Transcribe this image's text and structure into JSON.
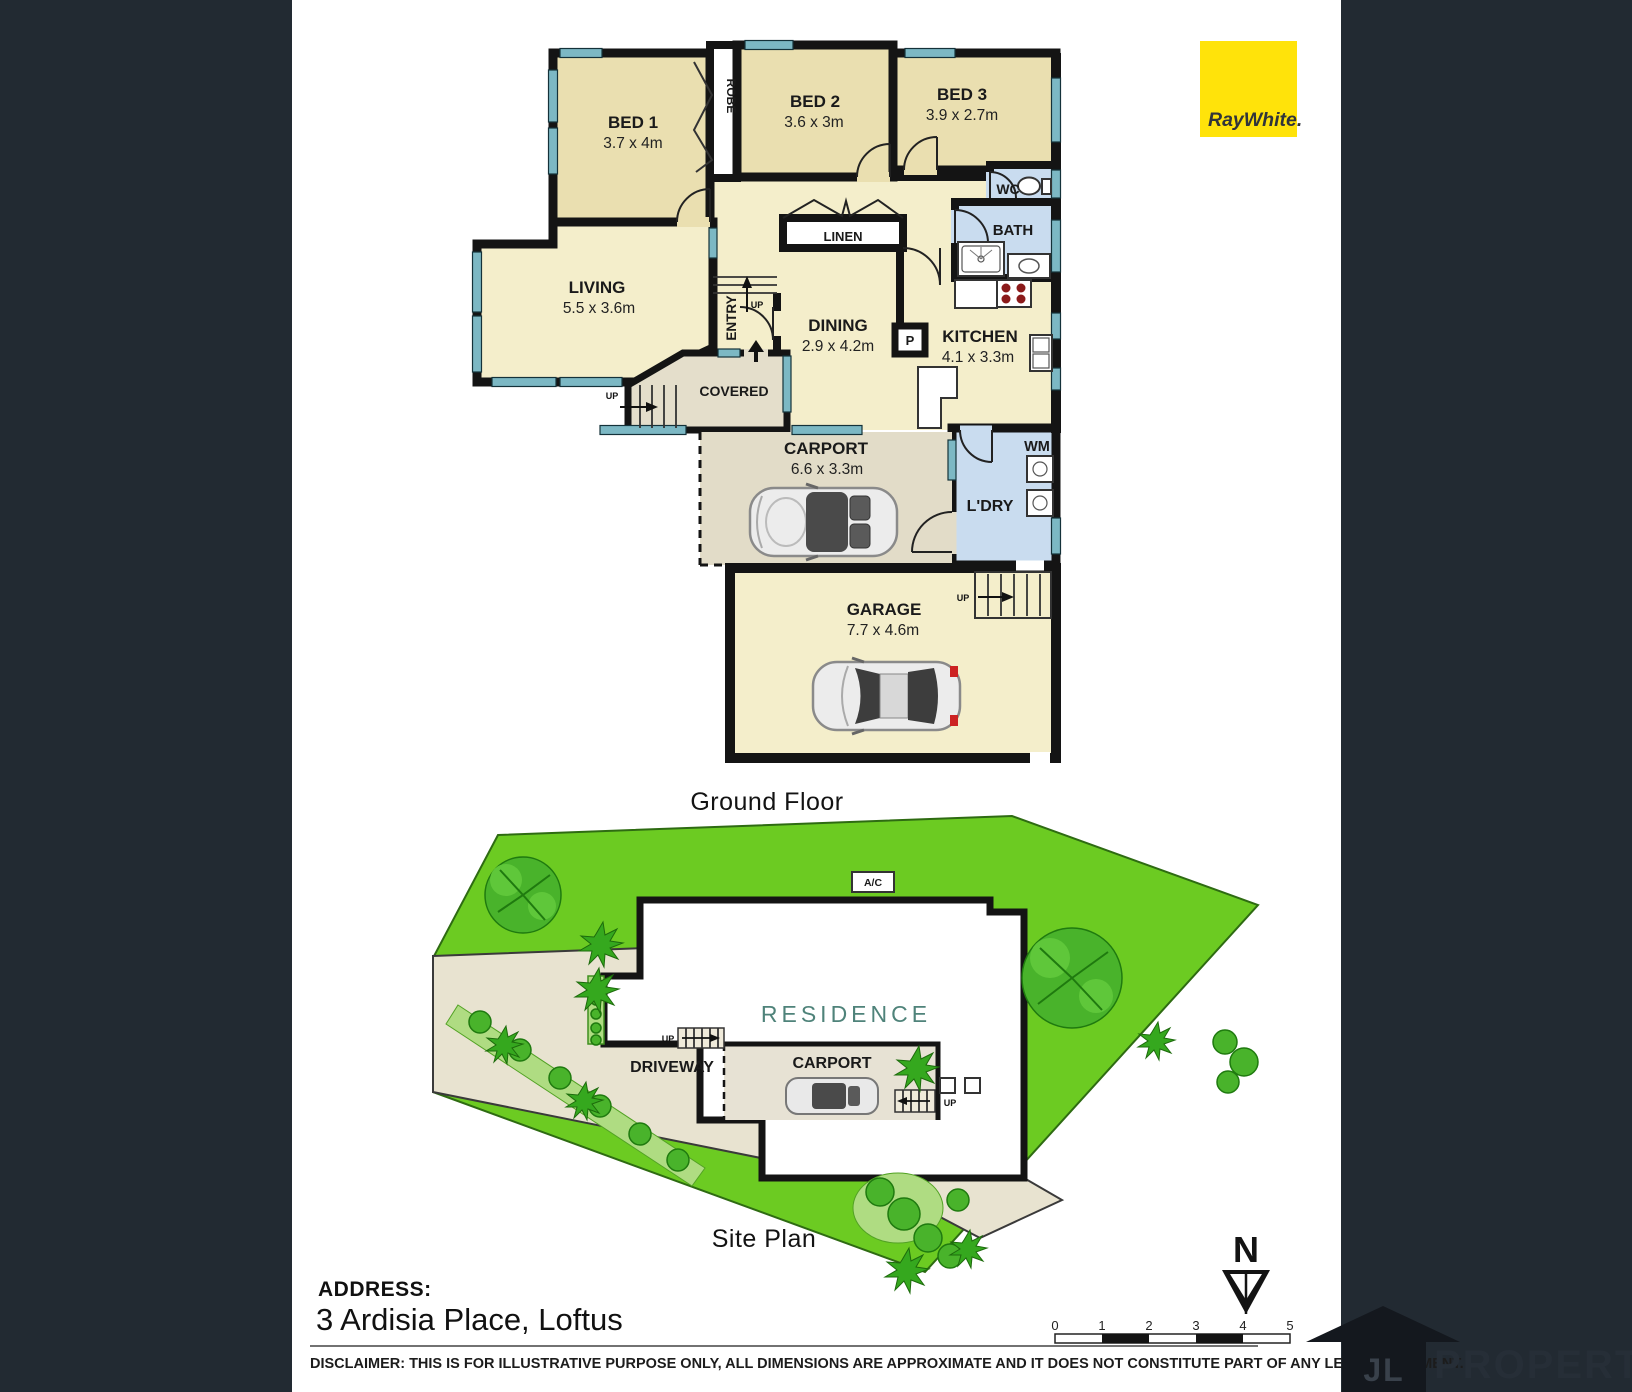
{
  "branding": {
    "ray_white": "RayWhite.",
    "jl_letters": "JL",
    "jl_property": "PROPERTY"
  },
  "titles": {
    "ground_floor": "Ground Floor",
    "site_plan": "Site Plan"
  },
  "address": {
    "label": "ADDRESS:",
    "value": "3 Ardisia Place, Loftus"
  },
  "disclaimer": "DISCLAIMER: THIS IS FOR ILLUSTRATIVE PURPOSE ONLY, ALL DIMENSIONS ARE APPROXIMATE AND IT DOES NOT CONSTITUTE PART OF ANY LEGAL DOCUMENT.",
  "north_label": "N",
  "scale_bar": {
    "ticks": [
      "0",
      "1",
      "2",
      "3",
      "4",
      "5"
    ]
  },
  "floorplan": {
    "rooms": {
      "bed1": {
        "name": "BED 1",
        "dims": "3.7 x 4m"
      },
      "bed2": {
        "name": "BED 2",
        "dims": "3.6 x 3m"
      },
      "bed3": {
        "name": "BED 3",
        "dims": "3.9 x 2.7m"
      },
      "living": {
        "name": "LIVING",
        "dims": "5.5 x 3.6m"
      },
      "dining": {
        "name": "DINING",
        "dims": "2.9 x 4.2m"
      },
      "kitchen": {
        "name": "KITCHEN",
        "dims": "4.1 x 3.3m"
      },
      "carport": {
        "name": "CARPORT",
        "dims": "6.6 x 3.3m"
      },
      "garage": {
        "name": "GARAGE",
        "dims": "7.7 x 4.6m"
      },
      "bath": {
        "name": "BATH"
      },
      "wc": {
        "name": "WC"
      },
      "laundry": {
        "name": "L'DRY"
      },
      "linen": {
        "name": "LINEN"
      },
      "robe": {
        "name": "ROBE"
      },
      "entry": {
        "name": "ENTRY"
      },
      "covered": {
        "name": "COVERED"
      },
      "wm": {
        "name": "WM"
      },
      "pantry": {
        "name": "P"
      }
    },
    "labels": {
      "up": "UP",
      "ac": "A/C"
    }
  },
  "site": {
    "residence": "RESIDENCE",
    "carport": "CARPORT",
    "driveway": "DRIVEWAY"
  },
  "colors": {
    "background": "#222A32",
    "page": "#FFFFFF",
    "wall": "#141414",
    "bedroom_fill": "#EADFB0",
    "living_fill": "#F4EECB",
    "wet_area_fill": "#C9DCEF",
    "window_teal": "#7CB8C4",
    "porch_fill": "#E4DECB",
    "carport_fill": "#E2DCC8",
    "grass": "#6CCB22",
    "tree": "#49B32B",
    "driveway_fill": "#E8E3D0",
    "residence_text": "#4F837A",
    "ray_white_yellow": "#FFE30A",
    "burner_red": "#8B1A1A"
  }
}
